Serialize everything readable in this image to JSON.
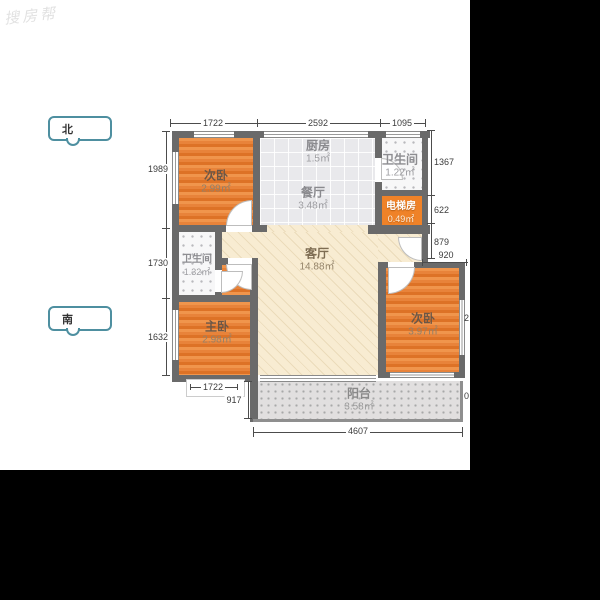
{
  "watermark": "搜房帮",
  "compass": {
    "north": "北",
    "south": "南"
  },
  "rooms": {
    "bedroom_top": {
      "name": "次卧",
      "area": "2.99㎡"
    },
    "kitchen": {
      "name": "厨房",
      "area": "1.5㎡"
    },
    "dining": {
      "name": "餐厅",
      "area": "3.48㎡"
    },
    "bath_top": {
      "name": "卫生间",
      "area": "1.22㎡"
    },
    "elevator": {
      "name": "电梯房",
      "area": "0.49㎡"
    },
    "living": {
      "name": "客厅",
      "area": "14.88㎡"
    },
    "bath_left": {
      "name": "卫生间",
      "area": "1.32㎡"
    },
    "master": {
      "name": "主卧",
      "area": "2.98㎡"
    },
    "bedroom_right": {
      "name": "次卧",
      "area": "3.97㎡"
    },
    "balcony": {
      "name": "阳台",
      "area": "3.58㎡"
    }
  },
  "dims": {
    "top": [
      "1722",
      "2592",
      "1095"
    ],
    "left": [
      "1989",
      "1730",
      "1632"
    ],
    "right": [
      "1367",
      "622",
      "879"
    ],
    "d920": "920",
    "bottom_1722": "1722",
    "d917": "917",
    "d4607": "4607",
    "frag_right_mid": "2",
    "frag_right_low": "0"
  },
  "colors": {
    "wall": "#6a6a6a",
    "wood_floor": "#e8833a",
    "elevator_room": "#ef8228",
    "living_floor": "#f8ecd2",
    "tile_floor": "#e9e9ec",
    "balcony_floor": "#e1dfdf",
    "compass_accent": "#4e8fa0",
    "padding": "#000000"
  }
}
